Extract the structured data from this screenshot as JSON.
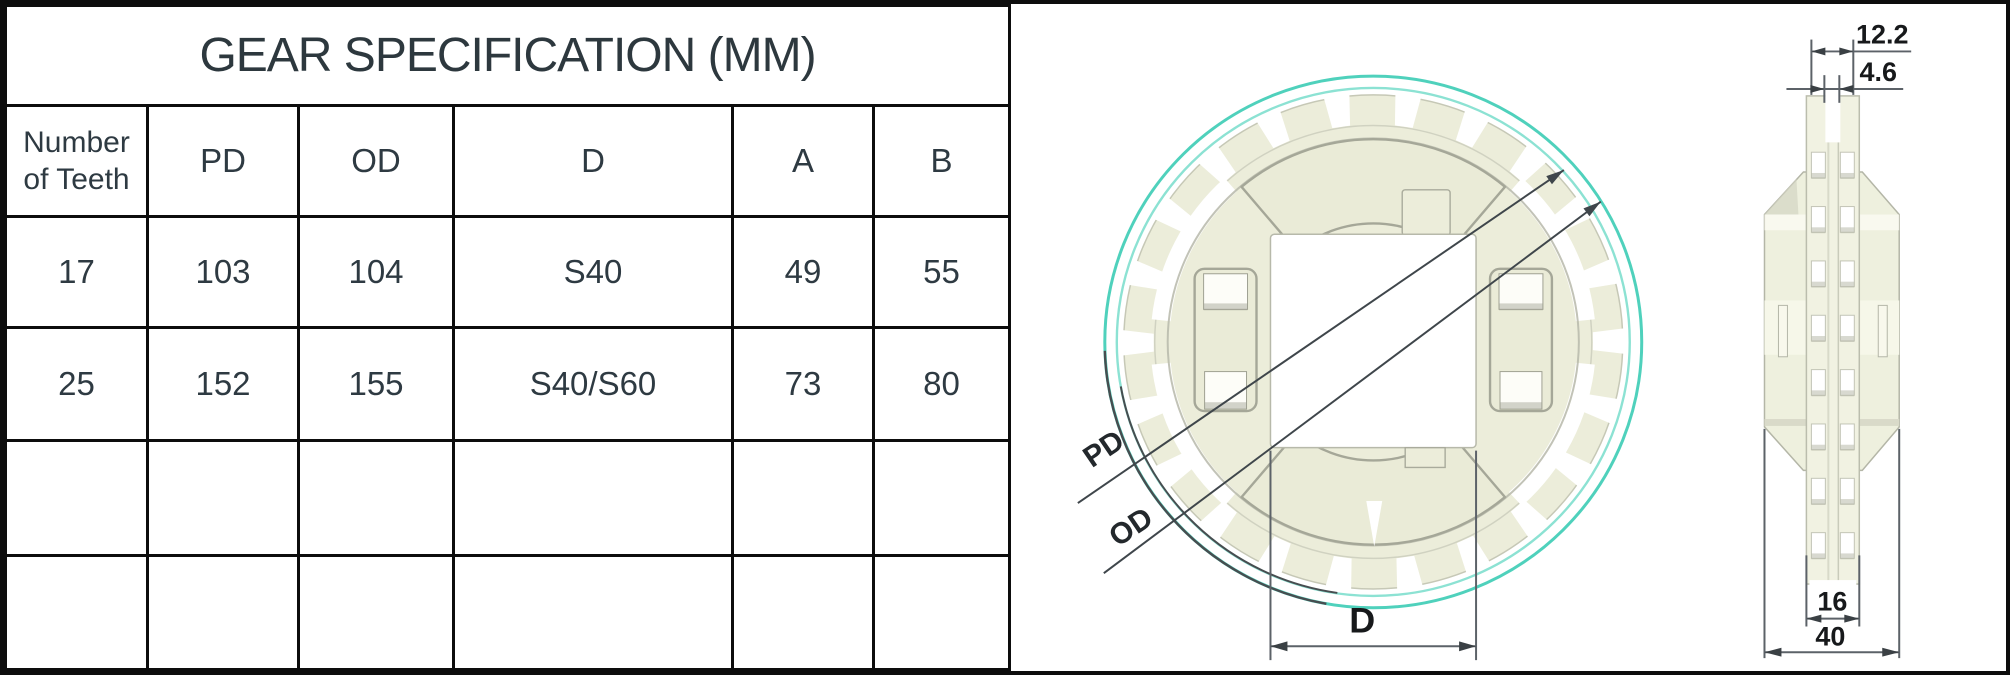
{
  "table": {
    "title": "GEAR SPECIFICATION (MM)",
    "columns": [
      "Number of Teeth",
      "PD",
      "OD",
      "D",
      "A",
      "B"
    ],
    "rows": [
      [
        "17",
        "103",
        "104",
        "S40",
        "49",
        "55"
      ],
      [
        "25",
        "152",
        "155",
        "S40/S60",
        "73",
        "80"
      ],
      [
        "",
        "",
        "",
        "",
        "",
        ""
      ],
      [
        "",
        "",
        "",
        "",
        "",
        ""
      ]
    ]
  },
  "drawing": {
    "front_view": {
      "pitch_diameter_label": "PD",
      "outer_diameter_label": "OD",
      "bore_dimension_label": "D"
    },
    "side_view": {
      "top_outer_width": "12.2",
      "top_inner_width": "4.6",
      "bottom_hub_width": "16",
      "bottom_overall_width": "40"
    },
    "colors": {
      "accent_teal": "#4FD1BC",
      "body_cream": "#ECEDDA",
      "line_dark": "#3F464B",
      "border_black": "#0D0D0D"
    }
  }
}
